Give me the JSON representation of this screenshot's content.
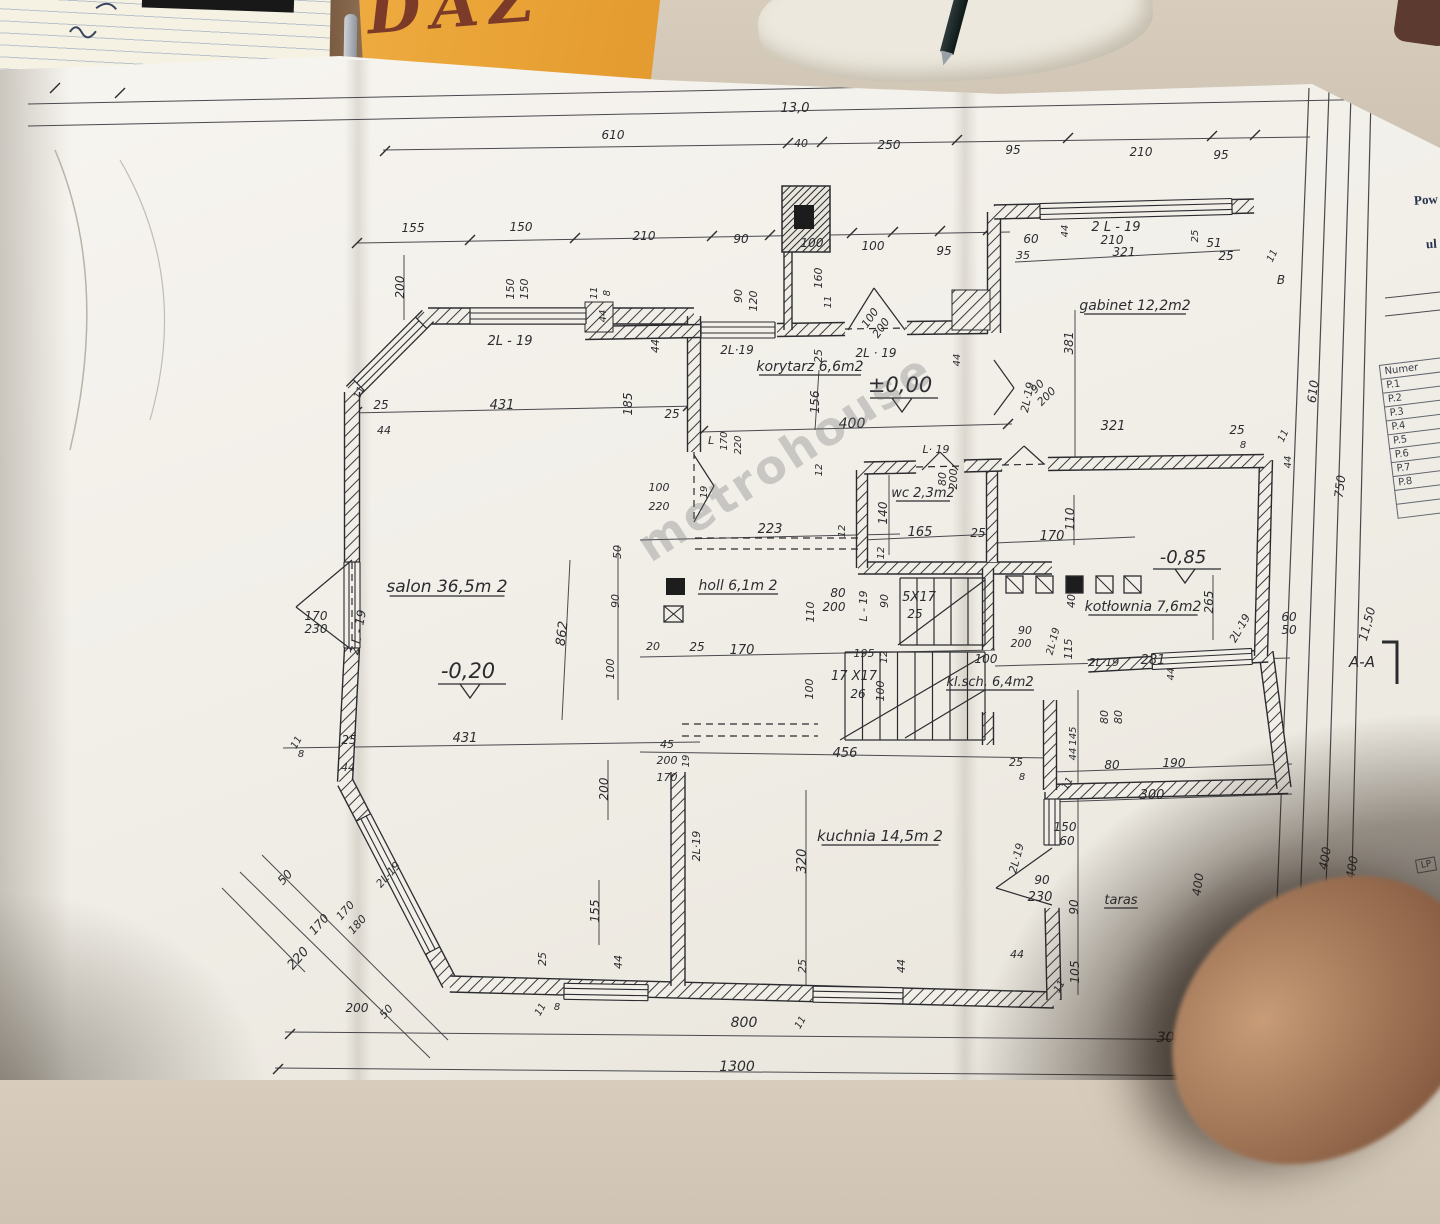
{
  "scene": {
    "sticky_note": {
      "text": "DAZ"
    },
    "watermark": "metrohouse"
  },
  "side_panel": {
    "heading_line1": "Pow",
    "heading_line2": "ul",
    "table": {
      "header": "Numer",
      "rows": [
        "P.1",
        "P.2",
        "P.3",
        "P.4",
        "P.5",
        "P.6",
        "P.7",
        "P.8"
      ]
    },
    "corner_cell": "LP"
  },
  "plan": {
    "section_marker": {
      "t": "A-A",
      "x": 1362,
      "y": 667
    },
    "levels": [
      {
        "t": "±0,00",
        "x": 900,
        "y": 392,
        "s": 21
      },
      {
        "t": "-0,20",
        "x": 468,
        "y": 678,
        "s": 21
      },
      {
        "t": "-0,85",
        "x": 1183,
        "y": 563,
        "s": 18
      }
    ],
    "rooms": [
      {
        "t": "salon 36,5m 2",
        "x": 447,
        "y": 592,
        "s": 17
      },
      {
        "t": "korytarz 6,6m2",
        "x": 810,
        "y": 371,
        "s": 14
      },
      {
        "t": "gabinet 12,2m2",
        "x": 1135,
        "y": 310,
        "s": 14
      },
      {
        "t": "wc 2,3m2",
        "x": 923,
        "y": 497,
        "s": 13
      },
      {
        "t": "holl 6,1m 2",
        "x": 738,
        "y": 590,
        "s": 14
      },
      {
        "t": "kotłownia 7,6m2",
        "x": 1143,
        "y": 611,
        "s": 14
      },
      {
        "t": "kl.sch. 6,4m2",
        "x": 990,
        "y": 686,
        "s": 13
      },
      {
        "t": "kuchnia 14,5m 2",
        "x": 880,
        "y": 841,
        "s": 15
      },
      {
        "t": "taras",
        "x": 1121,
        "y": 904,
        "s": 13
      }
    ],
    "dims": [
      {
        "t": "13,0",
        "x": 795,
        "y": 112,
        "s": 13
      },
      {
        "t": "610",
        "x": 613,
        "y": 139
      },
      {
        "t": "40",
        "x": 801,
        "y": 147,
        "s": 11
      },
      {
        "t": "250",
        "x": 889,
        "y": 149
      },
      {
        "t": "95",
        "x": 1013,
        "y": 154
      },
      {
        "t": "210",
        "x": 1141,
        "y": 156
      },
      {
        "t": "95",
        "x": 1221,
        "y": 159
      },
      {
        "t": "155",
        "x": 413,
        "y": 232
      },
      {
        "t": "150",
        "x": 521,
        "y": 231
      },
      {
        "t": "210",
        "x": 644,
        "y": 240
      },
      {
        "t": "90",
        "x": 741,
        "y": 243
      },
      {
        "t": "100",
        "x": 812,
        "y": 247
      },
      {
        "t": "100",
        "x": 873,
        "y": 250
      },
      {
        "t": "95",
        "x": 944,
        "y": 255
      },
      {
        "t": "200",
        "x": 404,
        "y": 287,
        "r": -90
      },
      {
        "t": "150",
        "x": 514,
        "y": 289,
        "r": -90,
        "s": 11
      },
      {
        "t": "150",
        "x": 528,
        "y": 289,
        "r": -90,
        "s": 11
      },
      {
        "t": "11",
        "x": 597,
        "y": 293,
        "r": -90,
        "s": 10
      },
      {
        "t": "8",
        "x": 610,
        "y": 293,
        "r": -90,
        "s": 10
      },
      {
        "t": "44",
        "x": 606,
        "y": 316,
        "r": -90,
        "s": 10
      },
      {
        "t": "90",
        "x": 742,
        "y": 296,
        "r": -90,
        "s": 11
      },
      {
        "t": "120",
        "x": 757,
        "y": 301,
        "r": -90,
        "s": 11
      },
      {
        "t": "160",
        "x": 822,
        "y": 278,
        "r": -90,
        "s": 11
      },
      {
        "t": "11",
        "x": 831,
        "y": 302,
        "r": -90,
        "s": 10
      },
      {
        "t": "2L - 19",
        "x": 510,
        "y": 345,
        "s": 13
      },
      {
        "t": "2L·19",
        "x": 737,
        "y": 354
      },
      {
        "t": "2L · 19",
        "x": 876,
        "y": 357
      },
      {
        "t": "25",
        "x": 822,
        "y": 356,
        "r": -90,
        "s": 11
      },
      {
        "t": "44",
        "x": 659,
        "y": 346,
        "r": -90,
        "s": 11
      },
      {
        "t": "25",
        "x": 672,
        "y": 418
      },
      {
        "t": "185",
        "x": 632,
        "y": 404,
        "r": -90
      },
      {
        "t": "431",
        "x": 502,
        "y": 409,
        "s": 13
      },
      {
        "t": "25",
        "x": 381,
        "y": 409
      },
      {
        "t": "11",
        "x": 362,
        "y": 394,
        "r": -65,
        "s": 10
      },
      {
        "t": "44",
        "x": 384,
        "y": 434,
        "s": 11
      },
      {
        "t": "156",
        "x": 819,
        "y": 402,
        "r": -90
      },
      {
        "t": "400",
        "x": 852,
        "y": 428,
        "s": 14
      },
      {
        "t": "100",
        "x": 873,
        "y": 320,
        "r": -55,
        "s": 11
      },
      {
        "t": "200",
        "x": 884,
        "y": 330,
        "r": -55,
        "s": 11
      },
      {
        "t": "35",
        "x": 1023,
        "y": 259,
        "s": 11
      },
      {
        "t": "60",
        "x": 1031,
        "y": 243
      },
      {
        "t": "44",
        "x": 1068,
        "y": 231,
        "r": -90,
        "s": 10
      },
      {
        "t": "2 L - 19",
        "x": 1116,
        "y": 231,
        "s": 13
      },
      {
        "t": "210",
        "x": 1112,
        "y": 244
      },
      {
        "t": "321",
        "x": 1124,
        "y": 256
      },
      {
        "t": "25",
        "x": 1198,
        "y": 236,
        "r": -90,
        "s": 10
      },
      {
        "t": "51",
        "x": 1214,
        "y": 247
      },
      {
        "t": "25",
        "x": 1226,
        "y": 260
      },
      {
        "t": "11",
        "x": 1275,
        "y": 257,
        "r": -65,
        "s": 10
      },
      {
        "t": "B",
        "x": 1281,
        "y": 284
      },
      {
        "t": "381",
        "x": 1073,
        "y": 343,
        "r": -90
      },
      {
        "t": "2L·19",
        "x": 1031,
        "y": 398,
        "r": -78,
        "s": 11
      },
      {
        "t": "90",
        "x": 1040,
        "y": 389,
        "r": -45,
        "s": 11
      },
      {
        "t": "200",
        "x": 1049,
        "y": 399,
        "r": -45,
        "s": 11
      },
      {
        "t": "44",
        "x": 960,
        "y": 360,
        "r": -90,
        "s": 10
      },
      {
        "t": "321",
        "x": 1113,
        "y": 430,
        "s": 13
      },
      {
        "t": "25",
        "x": 1237,
        "y": 434
      },
      {
        "t": "8",
        "x": 1243,
        "y": 448,
        "s": 10
      },
      {
        "t": "11",
        "x": 1286,
        "y": 437,
        "r": -65,
        "s": 10
      },
      {
        "t": "44",
        "x": 1291,
        "y": 462,
        "r": -90,
        "s": 10
      },
      {
        "t": "610",
        "x": 1317,
        "y": 392,
        "r": -83
      },
      {
        "t": "750",
        "x": 1344,
        "y": 487,
        "r": -83
      },
      {
        "t": "11,50",
        "x": 1371,
        "y": 625,
        "r": -75
      },
      {
        "t": "400",
        "x": 1356,
        "y": 868,
        "r": -80
      },
      {
        "t": "400",
        "x": 1329,
        "y": 859,
        "r": -80
      },
      {
        "t": "400",
        "x": 1202,
        "y": 885,
        "r": -82
      },
      {
        "t": "L· 19",
        "x": 936,
        "y": 453,
        "s": 11
      },
      {
        "t": "80",
        "x": 946,
        "y": 479,
        "r": -90,
        "s": 11
      },
      {
        "t": "200",
        "x": 957,
        "y": 479,
        "r": -90,
        "s": 11
      },
      {
        "t": "140",
        "x": 887,
        "y": 513,
        "r": -90
      },
      {
        "t": "165",
        "x": 920,
        "y": 536,
        "s": 13
      },
      {
        "t": "25",
        "x": 978,
        "y": 537
      },
      {
        "t": "12",
        "x": 884,
        "y": 553,
        "r": -90,
        "s": 10
      },
      {
        "t": "12",
        "x": 822,
        "y": 470,
        "r": -90,
        "s": 10
      },
      {
        "t": "110",
        "x": 1074,
        "y": 519,
        "r": -90
      },
      {
        "t": "170",
        "x": 1052,
        "y": 540,
        "s": 13
      },
      {
        "t": "223",
        "x": 770,
        "y": 533,
        "s": 13
      },
      {
        "t": "12",
        "x": 845,
        "y": 531,
        "r": -90,
        "s": 10
      },
      {
        "t": "110",
        "x": 814,
        "y": 612,
        "r": -90,
        "s": 11
      },
      {
        "t": "80",
        "x": 838,
        "y": 597
      },
      {
        "t": "200",
        "x": 834,
        "y": 611
      },
      {
        "t": "L - 19",
        "x": 867,
        "y": 606,
        "r": -90,
        "s": 11
      },
      {
        "t": "90",
        "x": 888,
        "y": 601,
        "r": -90,
        "s": 11
      },
      {
        "t": "5X17",
        "x": 919,
        "y": 601,
        "s": 13
      },
      {
        "t": "25",
        "x": 915,
        "y": 618
      },
      {
        "t": "20",
        "x": 653,
        "y": 650,
        "s": 11
      },
      {
        "t": "25",
        "x": 697,
        "y": 651
      },
      {
        "t": "170",
        "x": 742,
        "y": 654,
        "s": 13
      },
      {
        "t": "195",
        "x": 864,
        "y": 657,
        "s": 11
      },
      {
        "t": "12",
        "x": 887,
        "y": 657,
        "r": -90,
        "s": 10
      },
      {
        "t": "17 X17",
        "x": 854,
        "y": 680,
        "s": 13
      },
      {
        "t": "26",
        "x": 858,
        "y": 698
      },
      {
        "t": "100",
        "x": 813,
        "y": 689,
        "r": -90,
        "s": 11
      },
      {
        "t": "100",
        "x": 884,
        "y": 691,
        "r": -90,
        "s": 11
      },
      {
        "t": "100",
        "x": 986,
        "y": 663
      },
      {
        "t": "90",
        "x": 1025,
        "y": 634,
        "s": 11
      },
      {
        "t": "200",
        "x": 1021,
        "y": 647,
        "s": 11
      },
      {
        "t": "2L·19",
        "x": 1056,
        "y": 642,
        "r": -75,
        "s": 10
      },
      {
        "t": "115",
        "x": 1072,
        "y": 649,
        "r": -90,
        "s": 11
      },
      {
        "t": "2L·19",
        "x": 1104,
        "y": 666,
        "s": 11
      },
      {
        "t": "281",
        "x": 1153,
        "y": 664,
        "s": 13
      },
      {
        "t": "44",
        "x": 1174,
        "y": 674,
        "r": -90,
        "s": 10
      },
      {
        "t": "80",
        "x": 1108,
        "y": 717,
        "r": -90,
        "s": 11
      },
      {
        "t": "80",
        "x": 1122,
        "y": 717,
        "r": -90,
        "s": 11
      },
      {
        "t": "25",
        "x": 1016,
        "y": 766,
        "s": 11
      },
      {
        "t": "8",
        "x": 1022,
        "y": 780,
        "s": 10
      },
      {
        "t": "11",
        "x": 1070,
        "y": 785,
        "r": -60,
        "s": 10
      },
      {
        "t": "145",
        "x": 1076,
        "y": 736,
        "r": -90,
        "s": 10
      },
      {
        "t": "44",
        "x": 1076,
        "y": 754,
        "r": -90,
        "s": 10
      },
      {
        "t": "80",
        "x": 1112,
        "y": 769
      },
      {
        "t": "190",
        "x": 1174,
        "y": 767
      },
      {
        "t": "300",
        "x": 1152,
        "y": 799,
        "s": 13
      },
      {
        "t": "265",
        "x": 1213,
        "y": 602,
        "r": -90
      },
      {
        "t": "60",
        "x": 1289,
        "y": 621
      },
      {
        "t": "50",
        "x": 1289,
        "y": 634
      },
      {
        "t": "2L·19",
        "x": 1243,
        "y": 630,
        "r": -60,
        "s": 11
      },
      {
        "t": "40",
        "x": 1075,
        "y": 601,
        "r": -90,
        "s": 11
      },
      {
        "t": "320",
        "x": 806,
        "y": 861,
        "r": -90,
        "s": 13
      },
      {
        "t": "456",
        "x": 845,
        "y": 757,
        "s": 13
      },
      {
        "t": "150",
        "x": 1065,
        "y": 831
      },
      {
        "t": "60",
        "x": 1067,
        "y": 845
      },
      {
        "t": "2L·19",
        "x": 1020,
        "y": 859,
        "r": -75,
        "s": 11
      },
      {
        "t": "90",
        "x": 1042,
        "y": 884
      },
      {
        "t": "230",
        "x": 1040,
        "y": 901,
        "s": 13
      },
      {
        "t": "90",
        "x": 1078,
        "y": 907,
        "r": -90
      },
      {
        "t": "44",
        "x": 1017,
        "y": 958,
        "s": 11
      },
      {
        "t": "105",
        "x": 1079,
        "y": 972,
        "r": -90
      },
      {
        "t": "45",
        "x": 667,
        "y": 748,
        "s": 11
      },
      {
        "t": "200",
        "x": 667,
        "y": 764,
        "s": 11
      },
      {
        "t": "170",
        "x": 667,
        "y": 781,
        "s": 11
      },
      {
        "t": "19",
        "x": 689,
        "y": 761,
        "r": -90,
        "s": 10
      },
      {
        "t": "2L·19",
        "x": 700,
        "y": 846,
        "r": -90,
        "s": 11
      },
      {
        "t": "200",
        "x": 608,
        "y": 789,
        "r": -90
      },
      {
        "t": "155",
        "x": 599,
        "y": 911,
        "r": -90
      },
      {
        "t": "170",
        "x": 316,
        "y": 620
      },
      {
        "t": "230",
        "x": 316,
        "y": 633
      },
      {
        "t": "2 L - 19",
        "x": 362,
        "y": 633,
        "r": -80
      },
      {
        "t": "11",
        "x": 299,
        "y": 744,
        "r": -60,
        "s": 10
      },
      {
        "t": "8",
        "x": 301,
        "y": 757,
        "s": 10
      },
      {
        "t": "25",
        "x": 349,
        "y": 744
      },
      {
        "t": "44",
        "x": 348,
        "y": 771,
        "s": 11
      },
      {
        "t": "431",
        "x": 465,
        "y": 742,
        "s": 13
      },
      {
        "t": "50",
        "x": 288,
        "y": 880,
        "r": -48
      },
      {
        "t": "170",
        "x": 322,
        "y": 927,
        "r": -48
      },
      {
        "t": "220",
        "x": 301,
        "y": 961,
        "r": -48,
        "s": 13
      },
      {
        "t": "170",
        "x": 348,
        "y": 913,
        "r": -48,
        "s": 11
      },
      {
        "t": "180",
        "x": 360,
        "y": 927,
        "r": -48,
        "s": 11
      },
      {
        "t": "2L-19",
        "x": 391,
        "y": 877,
        "r": -48,
        "s": 11
      },
      {
        "t": "200",
        "x": 357,
        "y": 1012
      },
      {
        "t": "50",
        "x": 389,
        "y": 1014,
        "r": -48,
        "s": 11
      },
      {
        "t": "25",
        "x": 546,
        "y": 959,
        "r": -90,
        "s": 11
      },
      {
        "t": "44",
        "x": 622,
        "y": 962,
        "r": -90,
        "s": 11
      },
      {
        "t": "11",
        "x": 543,
        "y": 1011,
        "r": -60,
        "s": 10
      },
      {
        "t": "8",
        "x": 557,
        "y": 1010,
        "s": 10
      },
      {
        "t": "25",
        "x": 806,
        "y": 966,
        "r": -90,
        "s": 11
      },
      {
        "t": "11",
        "x": 803,
        "y": 1024,
        "r": -60,
        "s": 10
      },
      {
        "t": "800",
        "x": 744,
        "y": 1027,
        "s": 14
      },
      {
        "t": "1300",
        "x": 737,
        "y": 1071,
        "s": 14
      },
      {
        "t": "44",
        "x": 905,
        "y": 966,
        "r": -90,
        "s": 11
      },
      {
        "t": "300",
        "x": 1170,
        "y": 1042,
        "s": 14
      },
      {
        "t": "100",
        "x": 659,
        "y": 491,
        "s": 11
      },
      {
        "t": "220",
        "x": 659,
        "y": 510,
        "s": 11
      },
      {
        "t": "19",
        "x": 707,
        "y": 492,
        "r": -90,
        "s": 10
      },
      {
        "t": "L",
        "x": 711,
        "y": 444,
        "s": 11
      },
      {
        "t": "170",
        "x": 727,
        "y": 441,
        "r": -90,
        "s": 10
      },
      {
        "t": "220",
        "x": 741,
        "y": 445,
        "r": -90,
        "s": 10
      },
      {
        "t": "50",
        "x": 621,
        "y": 552,
        "r": -90,
        "s": 11
      },
      {
        "t": "90",
        "x": 619,
        "y": 601,
        "r": -90,
        "s": 11
      },
      {
        "t": "100",
        "x": 614,
        "y": 669,
        "r": -90,
        "s": 11
      },
      {
        "t": "862",
        "x": 566,
        "y": 634,
        "r": -83,
        "s": 13
      },
      {
        "t": "11",
        "x": 1062,
        "y": 988,
        "r": -60,
        "s": 10
      }
    ]
  }
}
